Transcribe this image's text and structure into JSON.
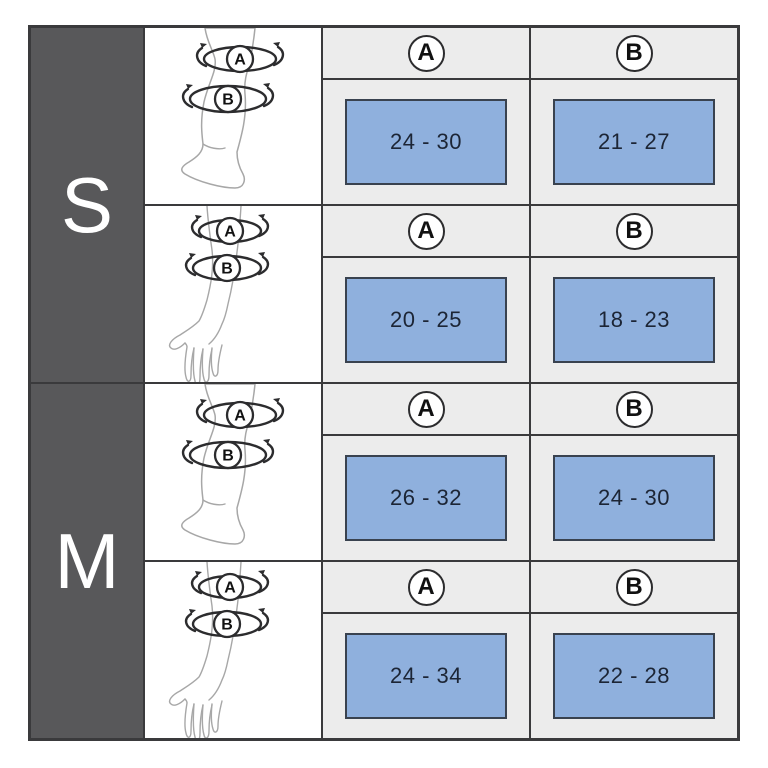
{
  "markers": {
    "a": "A",
    "b": "B"
  },
  "sizes": [
    {
      "label": "S",
      "rows": [
        {
          "limb": "leg",
          "a_range": "24 - 30",
          "b_range": "21 - 27"
        },
        {
          "limb": "arm",
          "a_range": "20 - 25",
          "b_range": "18 - 23"
        }
      ]
    },
    {
      "label": "M",
      "rows": [
        {
          "limb": "leg",
          "a_range": "26 - 32",
          "b_range": "24 - 30"
        },
        {
          "limb": "arm",
          "a_range": "24 - 34",
          "b_range": "22 - 28"
        }
      ]
    }
  ],
  "chart_data": {
    "type": "table",
    "columns": [
      "size",
      "limb",
      "A",
      "B"
    ],
    "rows": [
      [
        "S",
        "leg",
        "24 - 30",
        "21 - 27"
      ],
      [
        "S",
        "arm",
        "20 - 25",
        "18 - 23"
      ],
      [
        "M",
        "leg",
        "26 - 32",
        "24 - 30"
      ],
      [
        "M",
        "arm",
        "24 - 34",
        "22 - 28"
      ]
    ],
    "notes": "Size chart; A and B are circumference measurement points marked on leg (knee/calf) and arm (elbow/forearm) illustrations."
  },
  "colors": {
    "size_column_bg": "#58585a",
    "grid_line": "#3a3a3c",
    "measure_cell_bg": "#ececec",
    "value_box_fill": "#8fb0dd",
    "value_box_border": "#39424f",
    "value_text": "#1c2535",
    "size_letter": "#ffffff"
  }
}
